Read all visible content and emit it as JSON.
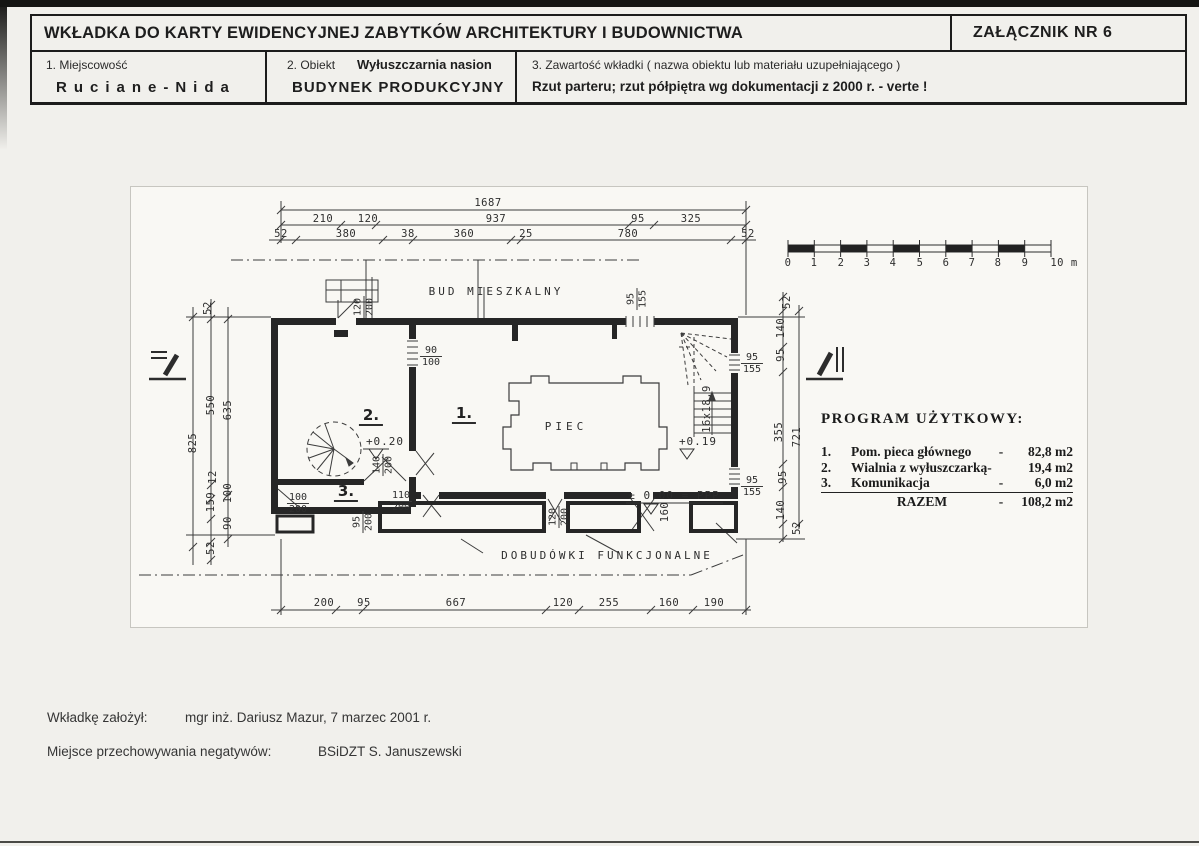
{
  "header": {
    "title": "WKŁADKA DO KARTY EWIDENCYJNEJ ZABYTKÓW ARCHITEKTURY I BUDOWNICTWA",
    "attachment": "ZAŁĄCZNIK NR 6",
    "field1_label": "1. Miejscowość",
    "field1_value": "Ruciane-Nida",
    "field2_label": "2. Obiekt",
    "field2_sub": "Wyłuszczarnia nasion",
    "field2_value": "BUDYNEK PRODUKCYJNY",
    "field3_label": "3. Zawartość wkładki ( nazwa obiektu lub materiału uzupełniającego )",
    "field3_value": "Rzut parteru; rzut półpiętra wg dokumentacji z 2000 r. - verte !"
  },
  "drawing": {
    "labels": {
      "neighbor_building": "BUD  MIESZKALNY",
      "furnace": "PIEC",
      "annexes": "DOBUDÓWKI  FUNKCJONALNE"
    },
    "rooms": {
      "r1": "1.",
      "r2": "2.",
      "r3": "3."
    },
    "levels": {
      "l020": "+0.20",
      "l019": "+0.19",
      "l000": "± 0.00 = PPP"
    },
    "stair_note": "16x18,9",
    "dims": {
      "top_total": "1687",
      "top_row2": [
        "210",
        "120",
        "937",
        "95",
        "325"
      ],
      "top_row3": [
        "52",
        "380",
        "38",
        "360",
        "25",
        "780",
        "52"
      ],
      "bottom": [
        "200",
        "95",
        "667",
        "120",
        "255",
        "160",
        "190"
      ],
      "left": [
        "52",
        "825",
        "550",
        "635",
        "12",
        "159",
        "100",
        "90",
        "52"
      ],
      "right": [
        "52",
        "140",
        "95",
        "355",
        "721",
        "95",
        "140",
        "52"
      ]
    },
    "fracs": {
      "f90_100": {
        "n": "90",
        "d": "100"
      },
      "f120_200_top": {
        "n": "120",
        "d": "200"
      },
      "f95_155_top": {
        "n": "95",
        "d": "155"
      },
      "f95_155_r1": {
        "n": "95",
        "d": "155"
      },
      "f95_155_r2": {
        "n": "95",
        "d": "155"
      },
      "f140_200": {
        "n": "140",
        "d": "200"
      },
      "f100_200": {
        "n": "100",
        "d": "200"
      },
      "f110_200": {
        "n": "110",
        "d": "200"
      },
      "f95_200": {
        "n": "95",
        "d": "200"
      },
      "f120_200_b": {
        "n": "120",
        "d": "200"
      },
      "d160": "160"
    },
    "scale": {
      "ticks": [
        "0",
        "1",
        "2",
        "3",
        "4",
        "5",
        "6",
        "7",
        "8",
        "9"
      ],
      "end_label": "10 m"
    }
  },
  "program": {
    "title": "PROGRAM UŻYTKOWY:",
    "rows": [
      {
        "no": "1.",
        "name": "Pom. pieca głównego",
        "dash": "-",
        "value": "82,8 m2"
      },
      {
        "no": "2.",
        "name": "Wialnia z wyłuszczarką-",
        "dash": "",
        "value": "19,4 m2"
      },
      {
        "no": "3.",
        "name": "Komunikacja",
        "dash": "-",
        "value": "6,0 m2"
      }
    ],
    "total": {
      "label": "RAZEM",
      "dash": "-",
      "value": "108,2 m2"
    }
  },
  "footer": {
    "founder_label": "Wkładkę założył:",
    "founder_value": "mgr inż. Dariusz Mazur, 7 marzec 2001 r.",
    "negatives_label": "Miejsce przechowywania negatywów:",
    "negatives_value": "BSiDZT S. Januszewski"
  }
}
